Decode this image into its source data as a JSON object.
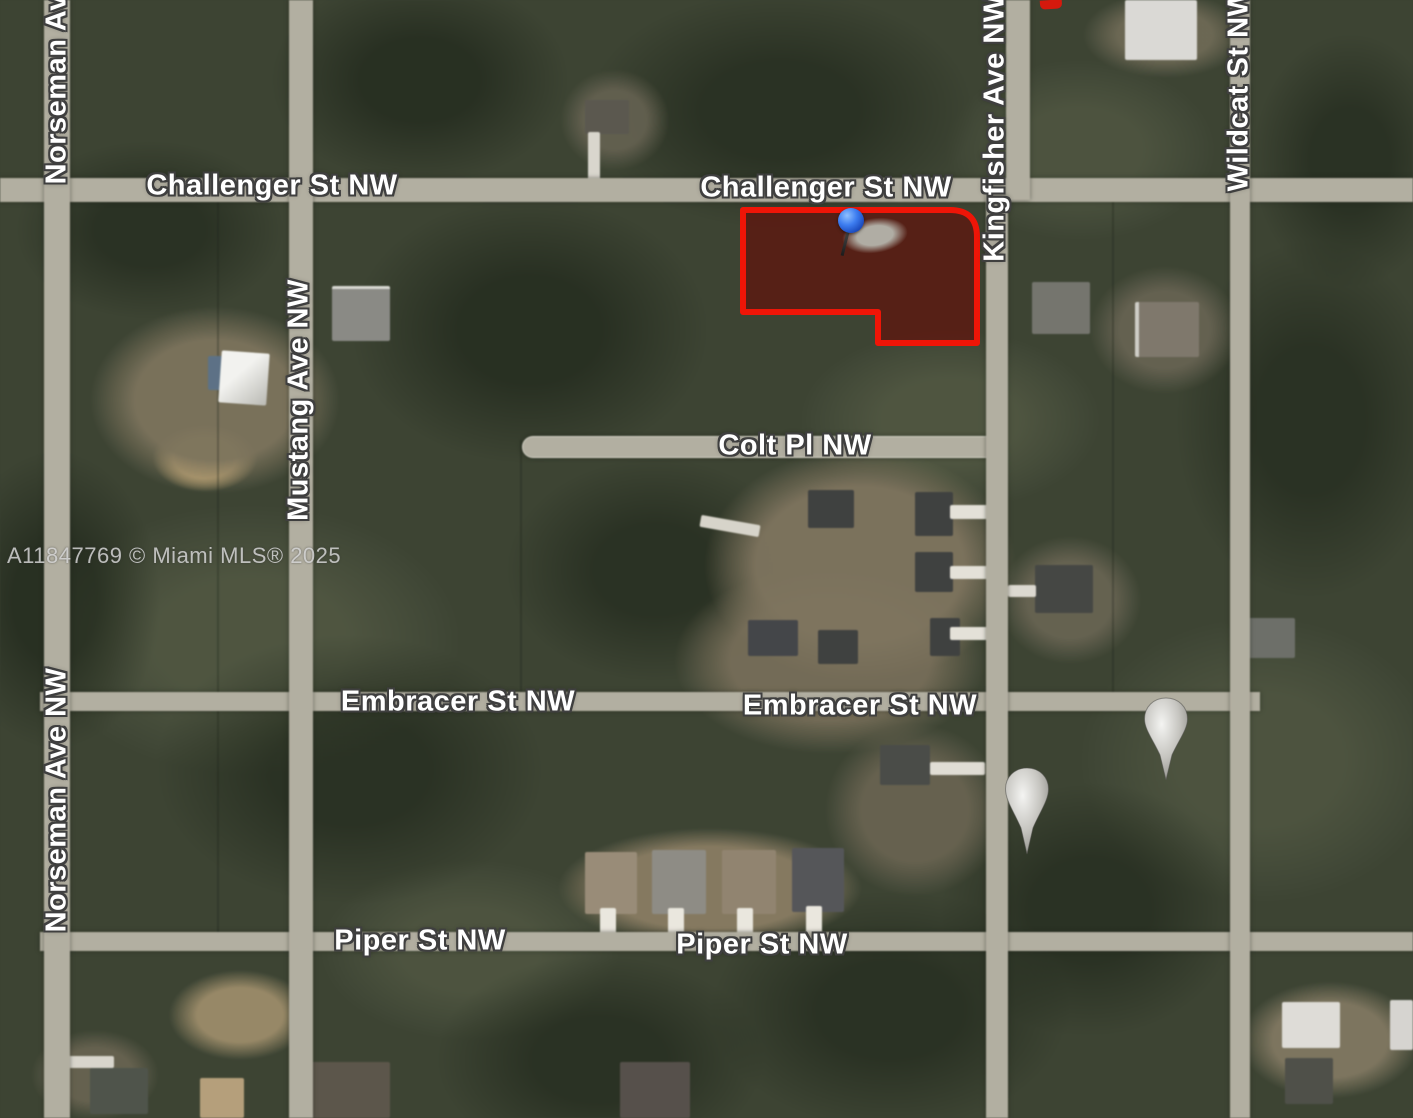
{
  "map": {
    "type": "satellite",
    "watermark": "A11847769 © Miami MLS® 2025",
    "street_labels": {
      "challenger_left": "Challenger St NW",
      "challenger_right": "Challenger St NW",
      "colt": "Colt Pl NW",
      "embracer_left": "Embracer St NW",
      "embracer_right": "Embracer St NW",
      "piper_left": "Piper St NW",
      "piper_right": "Piper St NW",
      "norseman_top": "Norseman Ave NW",
      "norseman_mid": "Norseman Ave NW",
      "mustang": "Mustang Ave NW",
      "kingfisher": "Kingfisher Ave NW",
      "wildcat": "Wildcat St NW"
    },
    "markers": {
      "parcel_outline_color": "#ef1507",
      "parcel_fill_color": "rgba(99,15,9,0.68)",
      "pushpin_color": "#2e6fe0",
      "balloon_marker_count": 2
    }
  }
}
